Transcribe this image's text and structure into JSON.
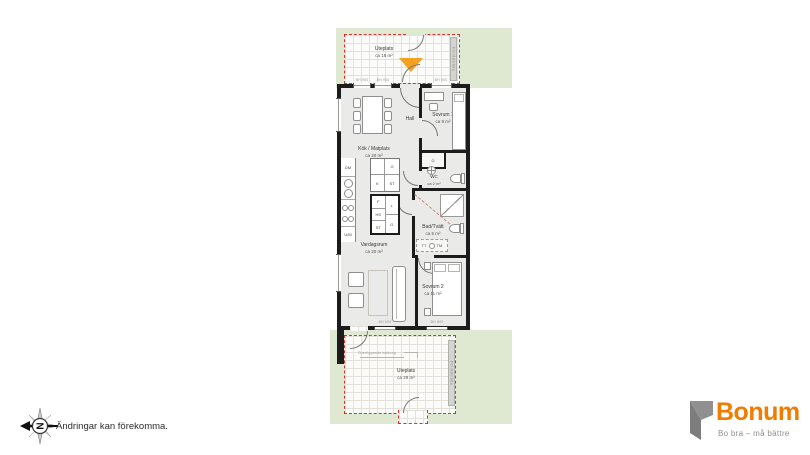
{
  "colors": {
    "terrace_green": "#dfe9d2",
    "boundary_red": "#cf3425",
    "wall_black": "#1c1c1c",
    "room_fill": "#eaeae8",
    "entrance_orange": "#f3a11f",
    "brand_orange": "#f07c00",
    "brand_gray": "#8e8e8e"
  },
  "terrace_top": {
    "name": "Uteplats",
    "area": "ca 18 m²",
    "side_label": "Förrådslåda"
  },
  "terrace_bottom": {
    "name": "Uteplats",
    "area": "ca 29 m²",
    "note": "Överliggande balkong",
    "side_label": "Förrådslåda"
  },
  "rooms": {
    "kitchen": {
      "name": "Kök / Matplats",
      "area": "ca 20 m²"
    },
    "hall": {
      "name": "Hall"
    },
    "bedroom1": {
      "name": "Sovrum 1",
      "area": "ca 9 m²"
    },
    "wc": {
      "name": "WC",
      "area": "ca 2 m²"
    },
    "bath": {
      "name": "Bad/Tvätt",
      "area": "ca 5 m²"
    },
    "living": {
      "name": "Vardagsrum",
      "area": "ca 20 m²"
    },
    "bedroom2": {
      "name": "Sovrum 2",
      "area": "ca 11 m²"
    }
  },
  "labels": {
    "dm": "DM",
    "um": "U/M",
    "closet_g": "G",
    "closet_k": "K",
    "closet_st": "ST",
    "closet_f": "F",
    "closet_hs": "HS",
    "closet_l": "L",
    "laundry_tt": "TT",
    "laundry_tm": "TM",
    "bh600": "BH 600",
    "bh900": "BH 900"
  },
  "footer": {
    "disclaimer": "Ändringar kan förekomma.",
    "compass_letter": "N"
  },
  "brand": {
    "name": "Bonum",
    "tagline": "Bo bra – må bättre"
  }
}
